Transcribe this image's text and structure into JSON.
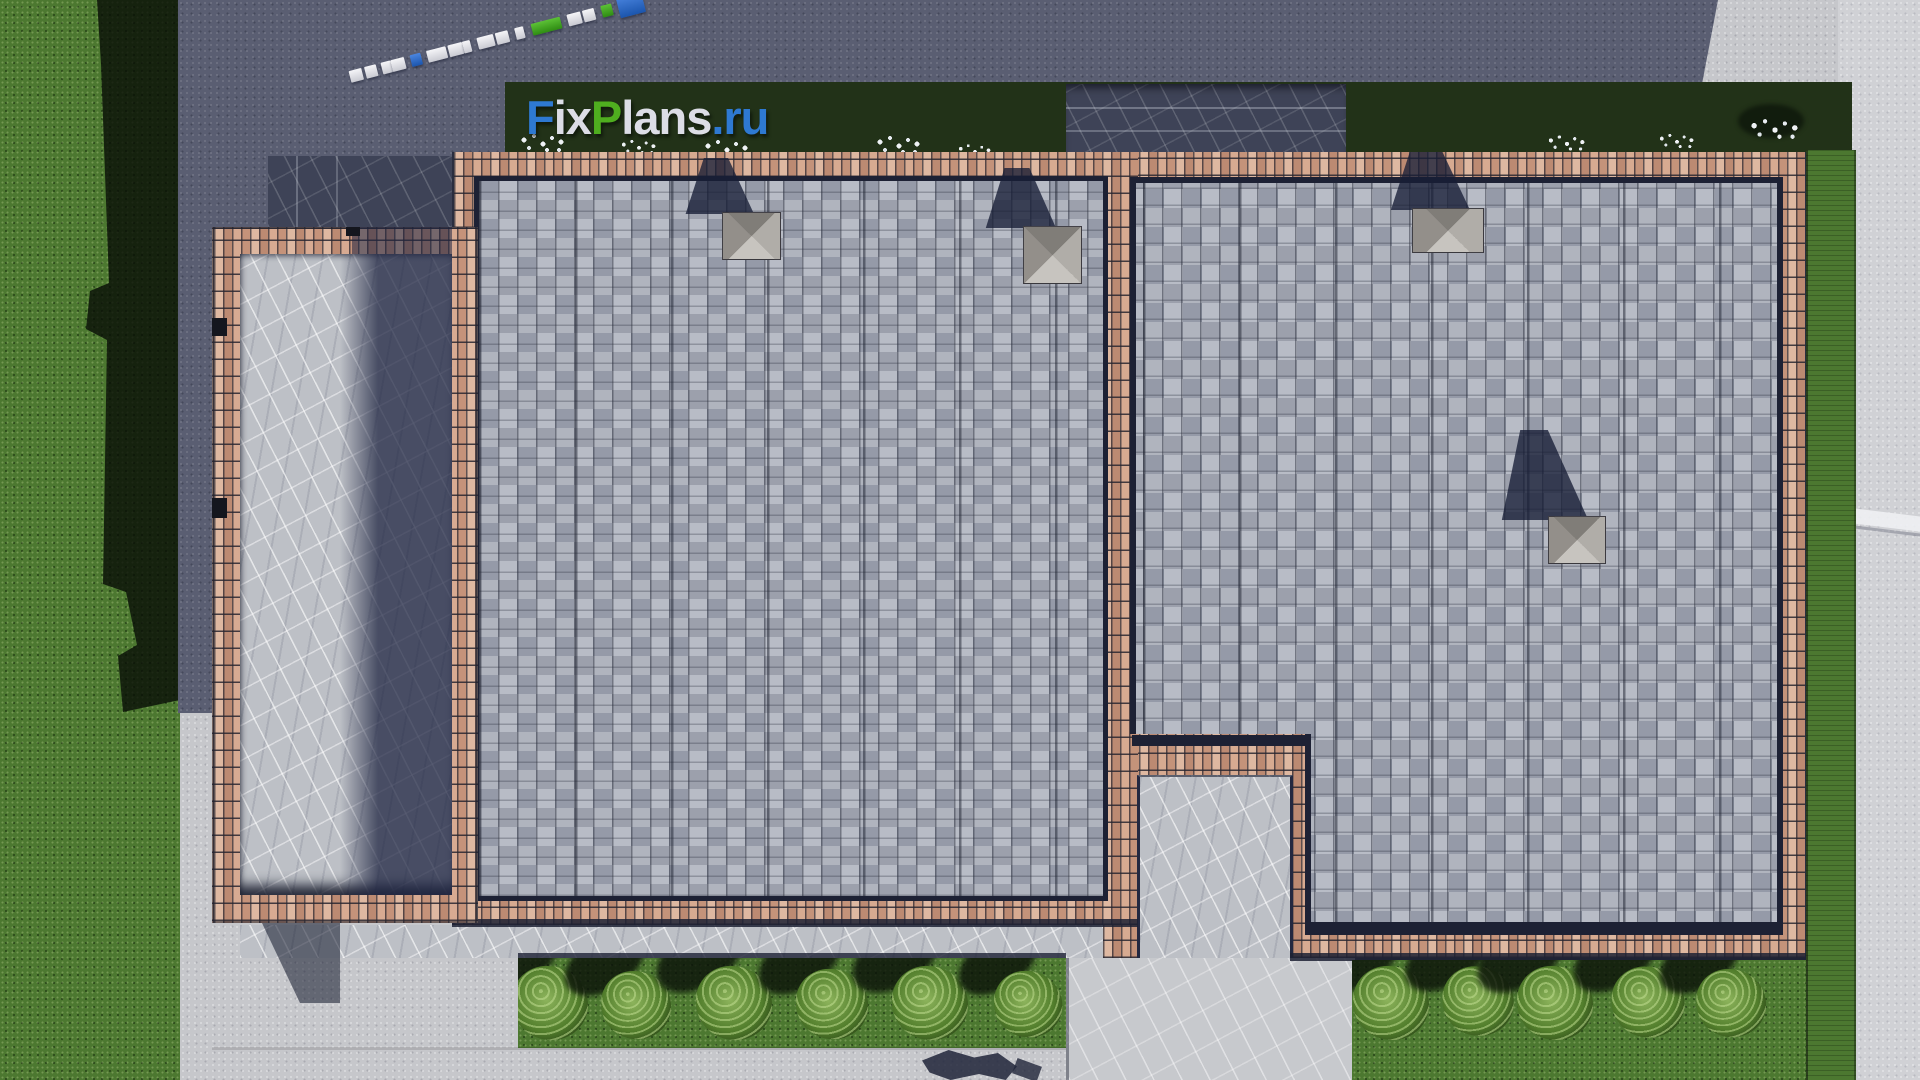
{
  "watermark": {
    "fix": "Fix",
    "plans": "Plans",
    "domain": ".ru"
  },
  "palette": {
    "logo_blue": "#2e79d2",
    "logo_green": "#4fae1f",
    "logo_light": "#dcdde6",
    "brick": "#c89b82",
    "brick_mortar": "#2f2d38",
    "shingle": "#a9adb7",
    "shingle_seam": "#2c3040",
    "concrete": "#c6c7cb",
    "concrete_right": "#d0d1d5",
    "concrete_shadow": "#5a5e72",
    "grass": "#4c7830",
    "grass_shadow": "#0d140a",
    "hedge": "#223218",
    "hedge_lit": "#3f6626",
    "marble": "#bdc0c6",
    "marble_dark": "#3e4357",
    "eave": "#1d2134",
    "chimney_light": "#c7c4bf",
    "chimney_dark": "#807d78",
    "flower_white": "#eef2f5",
    "marker_blue": "#1e63c8",
    "marker_green": "#3aa51a",
    "marker_white": "#eceef2"
  },
  "survey_marker": {
    "blocks": [
      {
        "c": "w",
        "w": 13
      },
      {
        "c": "gap",
        "w": 3
      },
      {
        "c": "w",
        "w": 12
      },
      {
        "c": "gap",
        "w": 5
      },
      {
        "c": "w",
        "w": 10
      },
      {
        "c": "w",
        "w": 14
      },
      {
        "c": "gap",
        "w": 6
      },
      {
        "c": "b",
        "w": 11
      },
      {
        "c": "gap",
        "w": 6
      },
      {
        "c": "w",
        "w": 20
      },
      {
        "c": "gap",
        "w": 2
      },
      {
        "c": "w",
        "w": 15
      },
      {
        "c": "w",
        "w": 8
      },
      {
        "c": "gap",
        "w": 7
      },
      {
        "c": "w",
        "w": 17
      },
      {
        "c": "gap",
        "w": 2
      },
      {
        "c": "w",
        "w": 13
      },
      {
        "c": "gap",
        "w": 7
      },
      {
        "c": "w",
        "w": 9
      },
      {
        "c": "gap",
        "w": 8
      },
      {
        "c": "g",
        "w": 30
      },
      {
        "c": "gap",
        "w": 7
      },
      {
        "c": "w",
        "w": 14
      },
      {
        "c": "gap",
        "w": 2
      },
      {
        "c": "w",
        "w": 12
      },
      {
        "c": "gap",
        "w": 7
      },
      {
        "c": "g",
        "w": 11
      },
      {
        "c": "gap",
        "w": 6
      },
      {
        "c": "b",
        "w": 26,
        "h": 22
      }
    ]
  },
  "counts": {
    "chimneys": 4,
    "bushes_left_bed": 6,
    "bushes_right_bed": 5
  }
}
